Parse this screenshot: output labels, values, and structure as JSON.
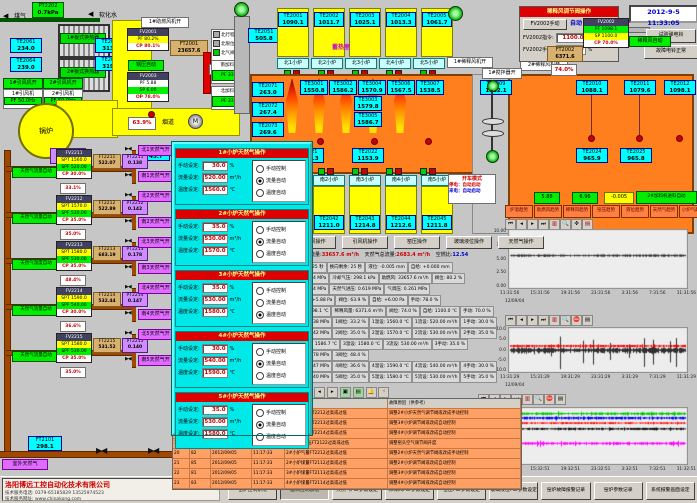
{
  "meta": {
    "datetime": "2012-9-5 11:33:05"
  },
  "top_left": {
    "gas_label": "煤气",
    "water_label": "软化水",
    "arrow_left": "◀",
    "pt2202": {
      "tag": "PT2202",
      "value": "0.7kPa"
    },
    "exchanger1": "1#板式换热器",
    "exchanger2": "2#板式换热器",
    "te2061": {
      "tag": "TE2061",
      "value": "234.0"
    },
    "te2064": {
      "tag": "TE2064",
      "value": "239.0"
    },
    "te2081": {
      "tag": "TE2081",
      "value": "313.0"
    },
    "te2063": {
      "tag": "TE2063",
      "value": "319.0"
    },
    "fan1_on": "1#引风机开",
    "fan2_on": "2#引风机开",
    "fan1_name": "1#引风机",
    "fan1_pf": "PF 50.0Hz",
    "fan2_name": "2#引风机",
    "fan2_pf": "PF 50.0Hz",
    "boiler_label": "锅炉",
    "pt2003": {
      "tag": "PT2003",
      "value": "-220.1"
    },
    "fv2001": {
      "tag": "FV2001",
      "pf": "PF 80.2%",
      "cp": "CP 80.1%"
    },
    "ft2001": {
      "tag": "FT2001",
      "value": "23657.6"
    },
    "boiler_auto": "锅压自动",
    "fv2003": {
      "tag": "FV2003",
      "pf": "PF 5.88",
      "sp": "SP 6.00",
      "op": "OP 78.0%"
    },
    "flue_valve": "63.9%",
    "flue_label": "烟道",
    "motor": "M",
    "te2053": {
      "tag": "TE2053",
      "value": "745.7"
    },
    "comb_fan_on": "1#助燃风机开",
    "comb_air_on": "助燃风开",
    "legend": [
      {
        "label": "北行程",
        "color": "#aaaaaa"
      },
      {
        "label": "北限位",
        "color": "#aaaaaa"
      },
      {
        "label": "北气阀",
        "color": "#00cc00"
      }
    ],
    "feeder1_name": "南加料机",
    "feeder1_pf": "PF 33.2",
    "feeder2_name": "北加料机",
    "feeder2_pf": "PF 33.4"
  },
  "regenerator": {
    "label": "蓄热室",
    "te2051": {
      "tag": "TE2051",
      "value": "505.8"
    },
    "chambers": [
      {
        "tag": "TE2001",
        "value": "1090.1"
      },
      {
        "tag": "TE2002",
        "value": "1011.7"
      },
      {
        "tag": "TE2003",
        "value": "1025.1"
      },
      {
        "tag": "TE2004",
        "value": "1013.3"
      },
      {
        "tag": "TE2005",
        "value": "1061.7"
      }
    ],
    "north_ports": [
      {
        "label": "北1小炉"
      },
      {
        "label": "北2小炉"
      },
      {
        "label": "北3小炉"
      },
      {
        "label": "北4小炉"
      },
      {
        "label": "北5小炉"
      }
    ]
  },
  "furnace": {
    "left_tes": [
      {
        "tag": "TE2071",
        "value": "263.0"
      },
      {
        "tag": "TE2072",
        "value": "267.4"
      },
      {
        "tag": "TE2073",
        "value": "269.6"
      },
      {
        "tag": "TE2074",
        "value": "268.6"
      }
    ],
    "crown_tes": [
      {
        "tag": "TE3001",
        "value": "1550.8"
      },
      {
        "tag": "TE3002",
        "value": "1586.2"
      },
      {
        "tag": "TE3004",
        "value": "1570.9"
      },
      {
        "tag": "TE3006",
        "value": "1567.5"
      },
      {
        "tag": "TE3007",
        "value": "1538.5"
      }
    ],
    "stack_tes": [
      {
        "tag": "TE3003",
        "value": "1579.8"
      },
      {
        "tag": "TE3005",
        "value": "1586.7"
      }
    ],
    "bottom_tes": [
      {
        "tag": "TE2021",
        "value": "1168.3"
      },
      {
        "tag": "TE2022",
        "value": "1153.9"
      }
    ],
    "te2009": {
      "tag": "TE2009",
      "value": "1522.1"
    },
    "te2010": {
      "tag": "TE2010",
      "value": "1088.1"
    },
    "te2011": {
      "tag": "TE2011",
      "value": "1079.6"
    },
    "te2012": {
      "tag": "TE2012",
      "value": "1098.1"
    },
    "te2024": {
      "tag": "TE2024",
      "value": "965.9"
    },
    "te2025": {
      "tag": "TE2025",
      "value": "965.8"
    },
    "stirrer_on": "1#搅拌器开",
    "dilution_fan1_on": "1#稀释风机开",
    "dilution_fan2_on": "2#稀释风机开"
  },
  "dilution_panel": {
    "title": "稀释风调节阀操作",
    "mode_button": "FV2002手动",
    "mode_state": "自动",
    "row1_label": "FV2002指令:",
    "row1_value": "1100.0",
    "row1_unit": "℃",
    "row2_label": "FV2002手动:",
    "row2_value": "70.0",
    "row2_unit": "%",
    "fv2002": {
      "tag": "FV2002",
      "pf": "PF 1098.1",
      "sp": "SP 1100.0",
      "cp": "CP 70.0%"
    },
    "auto_label": "稀释风自动",
    "valve_pos": "74.0%",
    "ft2002": {
      "tag": "FT2002",
      "value": "6371.6"
    },
    "bell_test": "试验弹电铃",
    "bell_normal": "故障电铃正常"
  },
  "popup": {
    "radio_labels": [
      "手动控制",
      "流量自动",
      "温度自动"
    ],
    "manual_label": "手动设定:",
    "flow_label": "流量设定:",
    "temp_label": "温度设定:",
    "units": {
      "manual": "%",
      "flow": "m³/h",
      "temp": "℃"
    },
    "sections": [
      {
        "title": "1#小炉天然气操作",
        "manual": "30.0",
        "flow": "520.00",
        "temp": "1560.0",
        "selected": 1
      },
      {
        "title": "2#小炉天然气操作",
        "manual": "35.0",
        "flow": "530.00",
        "temp": "1570.0",
        "selected": 1
      },
      {
        "title": "3#小炉天然气操作",
        "manual": "35.0",
        "flow": "530.00",
        "temp": "1580.0",
        "selected": 2
      },
      {
        "title": "4#小炉天然气操作",
        "manual": "30.0",
        "flow": "540.00",
        "temp": "1590.0",
        "selected": 1
      },
      {
        "title": "5#小炉天然气操作",
        "manual": "35.0",
        "flow": "530.00",
        "temp": "1580.0",
        "selected": 1
      }
    ]
  },
  "gas_branches": [
    {
      "auto_label": "天然气流量自动",
      "fv": "FV2211",
      "spt": "SPT 1560.0",
      "spf": "SPF 520.00",
      "cp": "CP 30.0%",
      "ft_tag": "FT2211",
      "flow": "522.07",
      "pt_tag": "PT2211",
      "press": "0.138",
      "pct": "33.1%",
      "north": "北1天然气开",
      "south": "南1天然气开"
    },
    {
      "auto_label": "天然气流量自动",
      "fv": "FV2212",
      "spt": "SPT 1570.0",
      "spf": "SPF 530.00",
      "cp": "CP 35.0%",
      "ft_tag": "FT2212",
      "flow": "522.89",
      "pt_tag": "PT2212",
      "press": "0.142",
      "pct": "35.0%",
      "north": "北2天然气开",
      "south": "南2天然气开"
    },
    {
      "auto_label": "天然气温度自动",
      "fv": "FV2213",
      "spt": "SPT 1580.0",
      "spf": "SPF 530.00",
      "cp": "CP 35.0%",
      "ft_tag": "FT2213",
      "flow": "683.19",
      "pt_tag": "PT2213",
      "press": "0.178",
      "pct": "48.4%",
      "north": "北3天然气开",
      "south": "南3天然气开"
    },
    {
      "auto_label": "天然气流量自动",
      "fv": "FV2214",
      "spt": "SPT 1590.0",
      "spf": "SPF 540.00",
      "cp": "CP 30.0%",
      "ft_tag": "FT2214",
      "flow": "532.44",
      "pt_tag": "PT2214",
      "press": "0.147",
      "pct": "36.6%",
      "north": "北4天然气开",
      "south": "南4天然气开"
    },
    {
      "auto_label": "天然气流量自动",
      "fv": "FV2215",
      "spt": "SPT 1580.0",
      "spf": "SPF 530.00",
      "cp": "CP 35.0%",
      "ft_tag": "FT2215",
      "flow": "531.52",
      "pt_tag": "PT2215",
      "press": "0.140",
      "pct": "35.0%",
      "north": "北5天然气开",
      "south": "南5天然气开"
    }
  ],
  "gas_main": {
    "outdoor": "室外天然气",
    "ft2101": {
      "tag": "FT2101",
      "value": "298.1"
    }
  },
  "south_row": {
    "ports": [
      {
        "label": "南1小炉"
      },
      {
        "label": "南2小炉"
      },
      {
        "label": "南3小炉"
      },
      {
        "label": "南4小炉"
      },
      {
        "label": "南5小炉"
      }
    ],
    "tes": [
      {
        "tag": "TE2041",
        "value": "1209.6"
      },
      {
        "tag": "TE2042",
        "value": "1211.0"
      },
      {
        "tag": "TE2043",
        "value": "1214.8"
      },
      {
        "tag": "TE2044",
        "value": "1212.6"
      },
      {
        "tag": "TE2045",
        "value": "1211.8"
      }
    ],
    "op_buttons": [
      {
        "label": "稀释风操作"
      },
      {
        "label": "引风机操作"
      },
      {
        "label": "窑压操作"
      },
      {
        "label": "玻璃液位操作"
      },
      {
        "label": "天然气操作"
      }
    ]
  },
  "startup_box": {
    "title": "开车模式",
    "row1": "停电：自动启动",
    "row2": "来电：自动启动"
  },
  "summary": {
    "l1": "助燃风总流量:",
    "v1": "33657.6 m³/h",
    "l2": "天然气总流量:",
    "v2": "2683.4 m³/h",
    "l3": "空燃比:",
    "v3": "12.54"
  },
  "param_rows": [
    {
      "c0": "换向设定: 25 秒",
      "c1": "换向剩余: 25 秒",
      "c2": "液位: -0.005 mm",
      "c3": "自给: +0.000 mm"
    },
    {
      "c0": "压力: 0.294 MPa",
      "c1": "冷却气压: 298.1 kPa",
      "c2": "助燃风: 33657.6 m³/h",
      "c3": "阀位: 80.2 %"
    },
    {
      "c0": "压力: 0.524 MPa",
      "c1": "天然气进压: 0.619 MPa",
      "c2": "气调压: 0.261 MPa"
    },
    {
      "c0": "烟道窑压: +5.88 Pa",
      "c1": "阀位: 63.9 %",
      "c2": "自给: +6.00 Pa",
      "c3": "手动: 78.0 %"
    },
    {
      "c0": "稀释风温: 98.1 ℃",
      "c1": "稀释风量: 6371.6 m³/h",
      "c2": "阀位: 74.0 %",
      "c3": "自给: 1100.0 ℃",
      "c4": "手动: 70.0 %"
    },
    {
      "c0": "1压力: 0.138 MPa",
      "c1": "1阀位: 33.2 %",
      "c2": "1温设: 1560.0 ℃",
      "c3": "1流设: 520.00 m³/h",
      "c4": "1手动: 30.0 %"
    },
    {
      "c0": "2压力: 0.142 MPa",
      "c1": "2阀位: 35.0 %",
      "c2": "2温设: 1570.0 ℃",
      "c3": "2流设: 530.00 m³/h",
      "c4": "2手动: 35.0 %"
    },
    {
      "c0": "3碹顶高温: 1586.7 ℃",
      "c1": "3温设: 1580.0 ℃",
      "c2": "3流设: 530.00 m³/h",
      "c3": "3手动: 35.0 %"
    },
    {
      "c0": "3压力: 0.178 MPa",
      "c1": "3阀位: 48.4 %"
    },
    {
      "c0": "4压力: 0.147 MPa",
      "c1": "4阀位: 36.6 %",
      "c2": "4温设: 1590.0 ℃",
      "c3": "4流设: 540.00 m³/h",
      "c4": "4手动: 30.0 %"
    },
    {
      "c0": "5压力: 0.140 MPa",
      "c1": "5阀位: 35.0 %",
      "c2": "5温设: 1580.0 ℃",
      "c3": "5流设: 530.00 m³/h",
      "c4": "5手动: 35.0 %"
    }
  ],
  "alarm": {
    "header_point": "故障点",
    "header_cause": "故障原因（供参考）",
    "rows": [
      {
        "no": "16",
        "code": "98",
        "date": "2012/09/05",
        "time": "11:17:21",
        "point": "2#小炉气量FT2212过高或过低",
        "cause": "调整2#小炉天然气调节阀或改成手动控制"
      },
      {
        "no": "17",
        "code": "97",
        "date": "2012/09/05",
        "time": "11:17:26",
        "point": "3#小炉气量FT2213过高或过低",
        "cause": "调整3#小炉调节阀或改成自动控制"
      },
      {
        "no": "18",
        "code": "97",
        "date": "2012/09/05",
        "time": "11:17:26",
        "point": "4#小炉气量FT2214过高或过低",
        "cause": "调整4#小炉调节阀或改成自动控制"
      },
      {
        "no": "19",
        "code": "75",
        "date": "2012/09/05",
        "time": "11:17:30",
        "point": "窑头空气计压FT2122过高或过低",
        "cause": "调整窑头空气调节阀开度"
      },
      {
        "no": "20",
        "code": "82",
        "date": "2012/09/05",
        "time": "11:17:33",
        "point": "2#小炉气量FT2212过高或过低",
        "cause": "调整2#小炉天然气调节阀或改成手动控制"
      },
      {
        "no": "21",
        "code": "85",
        "date": "2012/09/05",
        "time": "11:17:33",
        "point": "2#小炉煤量FT2112过高或过低",
        "cause": "调整2#小炉调节阀或改成自动控制"
      },
      {
        "no": "22",
        "code": "81",
        "date": "2012/09/05",
        "time": "11:17:33",
        "point": "3#小炉煤量FT2113过高或过低",
        "cause": "调整3#小炉调节阀或改成自动控制"
      },
      {
        "no": "23",
        "code": "83",
        "date": "2012/09/05",
        "time": "11:17:33",
        "point": "4#小炉煤量FT2114过高或过低",
        "cause": "调整4#小炉调节阀或改成自动控制"
      }
    ]
  },
  "status_boxes": {
    "b1": "5.88",
    "b2": "6.96",
    "b3": "-0.005",
    "b4": "2#加料机进料自动"
  },
  "trend_buttons": [
    {
      "label": "炉温趋势"
    },
    {
      "label": "助燃风趋势"
    },
    {
      "label": "稀释风趋势"
    },
    {
      "label": "窑压趋势"
    },
    {
      "label": "液位趋势"
    },
    {
      "label": "天然气趋势"
    },
    {
      "label": "小炉气趋势"
    }
  ],
  "chart_data": [
    {
      "type": "line",
      "title": "窑压趋势",
      "ylim": [
        0,
        10
      ],
      "y_ticks": [
        "10.00",
        "7.50",
        "5.00",
        "2.50",
        "0.00"
      ],
      "x_ticks": [
        "11:31:56",
        "15:31:56",
        "19:31:56",
        "23:31:56",
        "3:31:56",
        "7:31:56",
        "11:31:56"
      ],
      "start_date": "12/09/04",
      "grid": false,
      "legend_position": "none",
      "series": [
        {
          "name": "窑压",
          "color": "#303030",
          "base": 5.6,
          "amp": 0.2,
          "spike": 0
        }
      ]
    },
    {
      "type": "line",
      "title": "窑压波动趋势",
      "ylim": [
        -10,
        10
      ],
      "y_ticks": [
        "10.0",
        "5.0",
        "0.0",
        "-5.0",
        "-10.0"
      ],
      "x_ticks": [
        "11:31:29",
        "15:31:29",
        "19:31:29",
        "23:31:29",
        "3:31:29",
        "7:31:29",
        "11:31:29"
      ],
      "start_date": "12/09/04",
      "grid": false,
      "legend_position": "none",
      "series": [
        {
          "name": "窑压实测",
          "color": "#303030",
          "base": 0.0,
          "amp": 1.2,
          "spike": 7.0
        },
        {
          "name": "窑压给定",
          "color": "#ff0000",
          "base": 1.8,
          "amp": 0.5,
          "spike": 0.8
        }
      ]
    },
    {
      "type": "line",
      "title": "小炉温度趋势",
      "ylim": [
        1520,
        1600
      ],
      "y_ticks": [
        "1595.0",
        "1578.0",
        "1561.0",
        "1544.0",
        "1527.0"
      ],
      "x_ticks": [
        "11:32:51",
        "15:32:51",
        "19:32:51",
        "23:32:51",
        "3:32:51",
        "7:32:51",
        "11:32:51"
      ],
      "start_date": "12/09/04 11:32:51",
      "grid": false,
      "legend_position": "none",
      "series": [
        {
          "name": "1#小炉",
          "color": "#00cc00",
          "base": 1591,
          "amp": 1.8,
          "spike": 2.5
        },
        {
          "name": "2#小炉",
          "color": "#0000ff",
          "base": 1585,
          "amp": 1.8,
          "spike": 2.0
        },
        {
          "name": "3#小炉",
          "color": "#ff0000",
          "base": 1578,
          "amp": 1.2,
          "spike": 1.0
        },
        {
          "name": "4#小炉",
          "color": "#101010",
          "base": 1570,
          "amp": 1.5,
          "spike": 1.5
        },
        {
          "name": "5#小炉",
          "color": "#ff00ff",
          "base": 1550,
          "amp": 1.8,
          "spike": 4.0
        }
      ]
    }
  ],
  "footer": {
    "company": "洛阳博远工控自动化技术有限公司",
    "phone": "技术服务电话: 0379-65185829  13525974523",
    "web": "技术服务网址: www.chinakong.com",
    "buttons": [
      {
        "label": "窑炉控制系统"
      },
      {
        "label": "配料控制系统",
        "pressed": true
      },
      {
        "label": "天然气PID参数设定"
      },
      {
        "label": "稀释风PID参数设定"
      },
      {
        "label": "窑压PID参数设定"
      },
      {
        "label": "玻璃液位PID参数设定"
      },
      {
        "label": "窑炉故障报警记录"
      },
      {
        "label": "窑炉参数记录"
      },
      {
        "label": "系统报警画面设定"
      }
    ]
  }
}
